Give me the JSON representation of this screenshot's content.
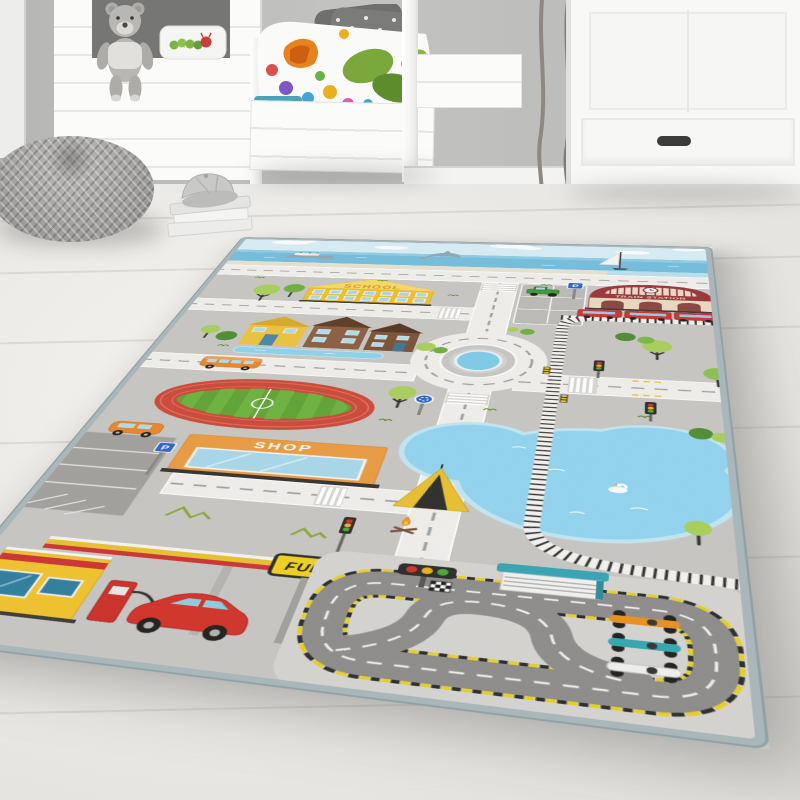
{
  "rug": {
    "labels": {
      "school": "SCHOOL",
      "train_station": "TRAIN STATION",
      "shop": "SHOP",
      "fuel_sign": "FUEL",
      "parking_sign": "P"
    },
    "features": [
      "sky-with-clouds",
      "sea",
      "ferry-ship",
      "dolphin",
      "sailboat",
      "coastal-road",
      "school-building",
      "trees",
      "houses",
      "river",
      "city-bus",
      "stadium-sports-field",
      "shop-building",
      "parking-lots",
      "orange-van",
      "green-tractor",
      "roundabout-with-pond",
      "zebra-crossings",
      "traffic-lights",
      "train-station",
      "red-train",
      "railway-track",
      "lake",
      "swan",
      "tent",
      "campfire",
      "race-track",
      "grandstand",
      "race-cars",
      "start-lights",
      "checkered-flag",
      "fuel-station",
      "fuel-pump",
      "red-car",
      "roundabout-sign",
      "mountain-marks"
    ],
    "colors": {
      "base_gray": "#c8c6c2",
      "binding": "#a9b6ba",
      "sky": "#d8edf6",
      "sea": "#74bedd",
      "road": "#f0efec",
      "lake": "#92d4ef",
      "school_yellow": "#f0c02a",
      "shop_orange": "#eb9a40",
      "station_red": "#9a3438",
      "track_red": "#cc4838",
      "field_green": "#5a9e32",
      "race_asphalt": "#8e8c8a",
      "curb_yellow": "#e8d020",
      "fuel_yellow": "#f0c22a",
      "car_red": "#d23228",
      "sign_blue": "#2f62c8",
      "tent_yellow": "#e8c030"
    }
  },
  "room": {
    "objects": [
      "wall",
      "window-frame",
      "house-bed",
      "teddy-bear",
      "caterpillar-pillow",
      "bed",
      "polka-dot-pillows",
      "caterpillar-duvet",
      "teal-mattress",
      "branch-decor",
      "wardrobe",
      "wardrobe-handle",
      "baseboard",
      "wood-floor",
      "knitted-pouf",
      "book-stack",
      "baseball-cap"
    ],
    "colors": {
      "wall": "#c0c0be",
      "furniture_white": "#f8f8f6",
      "floor": "#ebe9e5",
      "pouf_gray": "#a3a2a0",
      "mattress_teal": "#4aa3b8"
    }
  }
}
